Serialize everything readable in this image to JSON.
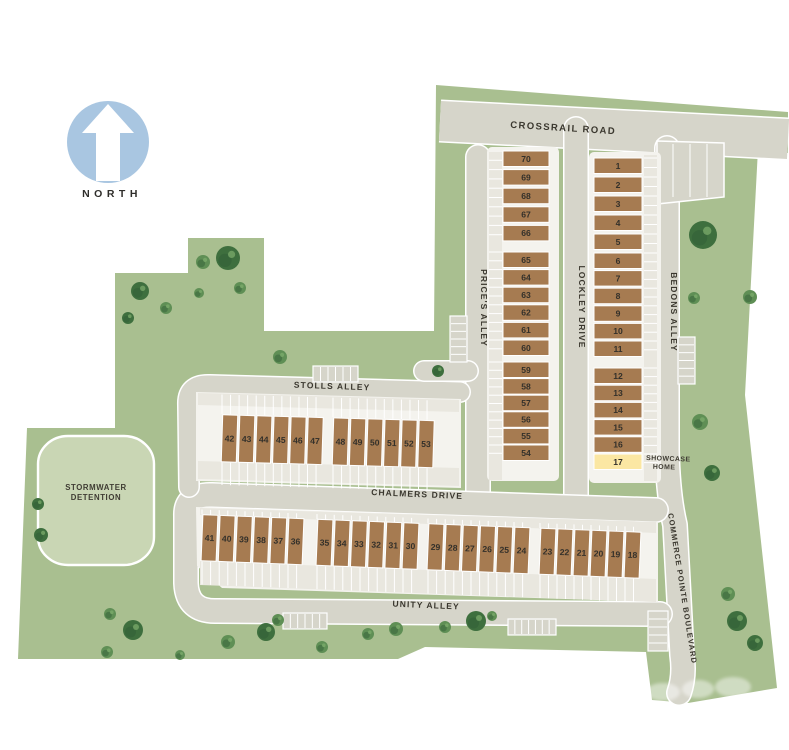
{
  "compass": {
    "label": "NORTH"
  },
  "streets": {
    "crossrail": "CROSSRAIL ROAD",
    "prices": "PRICE'S ALLEY",
    "lockley": "LOCKLEY DRIVE",
    "bedons": "BEDONS ALLEY",
    "stolls": "STOLLS ALLEY",
    "chalmers": "CHALMERS DRIVE",
    "unity": "UNITY ALLEY",
    "commerce": "COMMERCE POINTE BOULEVARD"
  },
  "stormwater": {
    "line1": "STORMWATER",
    "line2": "DETENTION"
  },
  "showcase": {
    "line1": "SHOWCASE",
    "line2": "HOME",
    "lot": "17"
  },
  "lots": {
    "west_column_groups": [
      [
        "70",
        "69",
        "68",
        "67",
        "66"
      ],
      [
        "65",
        "64",
        "63",
        "62",
        "61",
        "60"
      ],
      [
        "59",
        "58",
        "57",
        "56",
        "55",
        "54"
      ]
    ],
    "east_column_groups": [
      [
        "1",
        "2",
        "3",
        "4",
        "5"
      ],
      [
        "6",
        "7",
        "8",
        "9",
        "10",
        "11"
      ],
      [
        "12",
        "13",
        "14",
        "15",
        "16",
        "17"
      ]
    ],
    "stolls_row_groups": [
      [
        "42",
        "43",
        "44",
        "45",
        "46",
        "47"
      ],
      [
        "48",
        "49",
        "50",
        "51",
        "52",
        "53"
      ]
    ],
    "south_row_groups": [
      [
        "41",
        "40",
        "39",
        "38",
        "37",
        "36"
      ],
      [
        "35",
        "34",
        "33",
        "32",
        "31",
        "30"
      ],
      [
        "29",
        "28",
        "27",
        "26",
        "25",
        "24"
      ],
      [
        "23",
        "22",
        "21",
        "20",
        "19",
        "18"
      ]
    ]
  },
  "colors": {
    "parcel_green": "#a9bf90",
    "road_gray": "#d6d5ca",
    "pad_white": "#f4f3ee",
    "strip_gray": "#e9e7df",
    "lot_brown": "#a67b51",
    "showcase_yellow": "#fbe7a3",
    "stormwater_green": "#c9d6b4",
    "north_blue": "#a9c6e1",
    "tree_dark": "#3e6f3e",
    "tree_medium": "#5f8f55",
    "label_ink": "#3a372e"
  }
}
